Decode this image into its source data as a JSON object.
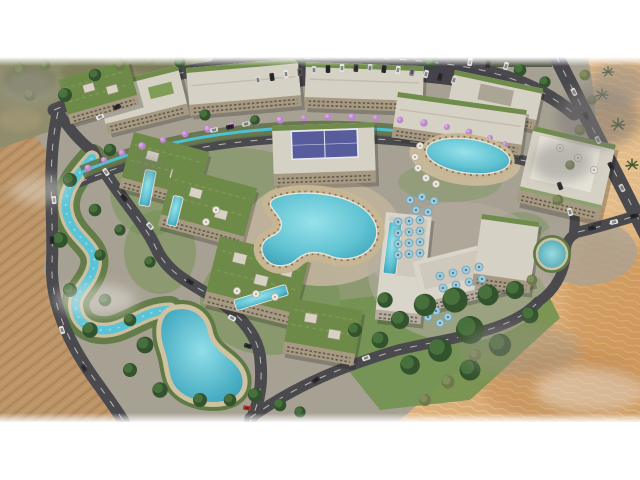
{
  "scene": {
    "title": "Aerial dusk rendering of a desert resort and residential masterplan",
    "type": "architectural-visualization-render",
    "environment": {
      "top_left": "olive desert scrub with dark trees and dust haze",
      "left": "plowed tan desert field with furrow lines and light smoke wisps",
      "right": "rippled golden sand dunes with palm trees and dust clouds",
      "framing": "white letterbox bands above and below the render"
    },
    "water_features": {
      "lazy_river": "winding turquoise stream between two curving roads on the left",
      "lagoon": "large freeform turquoise lagoon at lower left of the compound",
      "main_pool": "large freeform resort pool with tan deck and sun loungers",
      "oval_pool": "rounded rectangular pool with white umbrellas, upper right",
      "lap_pools": 4,
      "round_pond": "small circular landscaped pond near the hotel",
      "spine_channel": "teal water channel lined with purple flowering trees along the central spine"
    },
    "buildings": {
      "top_arc_apartment_blocks": 4,
      "green_roof_villas": 5,
      "padel_building": "mid-rise block with blue rooftop padel court",
      "hotel": "L-shaped white hotel with light-blue rooftop umbrellas",
      "clubhouse": "large flat light-roof building at the right",
      "total_blocks": 15
    },
    "vegetation": {
      "flowering_trees": "row of purple/pink trees along the central spine",
      "tree_clusters": "dense dark green canopy at bottom center and along river banks",
      "palms": 4
    },
    "vehicles": {
      "cars_total_approx": 38,
      "parked_rows": "angled parking along the top access loop",
      "red_car": "single red car on the lower left road"
    },
    "palette": {
      "background": "#ffffff",
      "road": "#4a4a4e",
      "lane_marking": "#e8e8e2",
      "river_water": "#58c4d6",
      "lagoon_water": "#3aa0ba",
      "pool_water": "#49b4c9",
      "lawn": "#71924f",
      "tree": "#33522e",
      "building_facade": "#a79a83",
      "roof_light": "#d6d1c5",
      "roof_green": "#6d8a48",
      "pool_deck": "#c7b694",
      "sand_dunes": "#e2b87c",
      "plowed_field": "#c49c6e",
      "scrub": "#8f8d6c",
      "flowering_tree": "#bb86cc",
      "umbrella_blue": "#9ccbdc",
      "umbrella_white": "#e9e7df",
      "padel_court": "#565c9c",
      "haze": "#8a8884"
    }
  }
}
